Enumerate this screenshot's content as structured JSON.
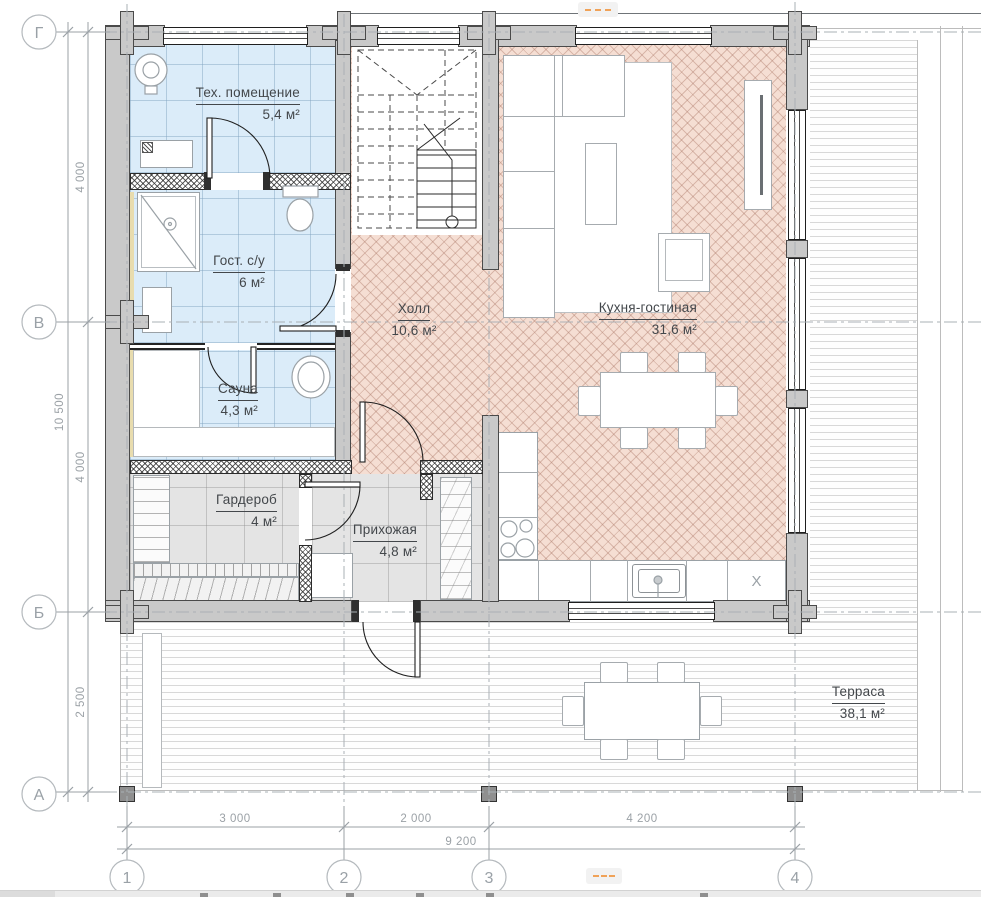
{
  "plan": {
    "rooms": [
      {
        "name": "Тех. помещение",
        "area": "5,4 м²"
      },
      {
        "name": "Гост. с/у",
        "area": "6 м²"
      },
      {
        "name": "Сауна",
        "area": "4,3 м²"
      },
      {
        "name": "Гардероб",
        "area": "4 м²"
      },
      {
        "name": "Прихожая",
        "area": "4,8 м²"
      },
      {
        "name": "Холл",
        "area": "10,6 м²"
      },
      {
        "name": "Кухня-гостиная",
        "area": "31,6 м²"
      },
      {
        "name": "Терраса",
        "area": "38,1 м²"
      }
    ],
    "axes": {
      "rows": [
        "Г",
        "В",
        "Б",
        "А"
      ],
      "cols": [
        "1",
        "2",
        "3",
        "4"
      ]
    },
    "dims": {
      "v": [
        "4 000",
        "4 000",
        "2 500"
      ],
      "v_total": "10 500",
      "h": [
        "3 000",
        "2 000",
        "4 200"
      ],
      "h_total": "9 200"
    },
    "marks": {
      "appliance": "X"
    },
    "colors": {
      "tile_blue": "#dbecf9",
      "parquet": "#f5ded3",
      "tile_gray": "#e4e4e4",
      "wall_gray": "#c9c9c9",
      "accent_orange": "#f0a258",
      "dim_text": "#9ba1a6",
      "label_text": "#43474b"
    }
  }
}
